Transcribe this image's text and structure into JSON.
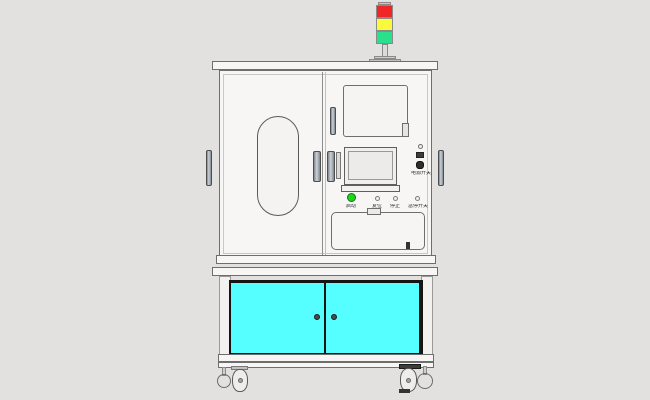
{
  "scene_colors": {
    "background": "#e3e0e0",
    "machine_body": "#f8f6f5",
    "outline": "#6e6e6e",
    "lower_door_cyan": "#55ffff",
    "lower_door_frame": "#151515",
    "signal_red": "#f02626",
    "signal_yellow": "#fafa3c",
    "signal_green": "#2be08c",
    "start_button_green": "#1fd41f"
  },
  "signal_tower": {
    "lights": [
      {
        "name": "red",
        "color": "#f02626"
      },
      {
        "name": "yellow",
        "color": "#fafa3c"
      },
      {
        "name": "green",
        "color": "#2be08c"
      }
    ]
  },
  "control_panel": {
    "buttons": [
      {
        "label": "启动",
        "style": "green-pushbutton"
      },
      {
        "label": "复位",
        "style": "small-round"
      },
      {
        "label": "停止",
        "style": "small-round"
      },
      {
        "label": "急停开关",
        "style": "small-round"
      }
    ],
    "side_panel": {
      "power_switch_label": "电源开关"
    }
  }
}
